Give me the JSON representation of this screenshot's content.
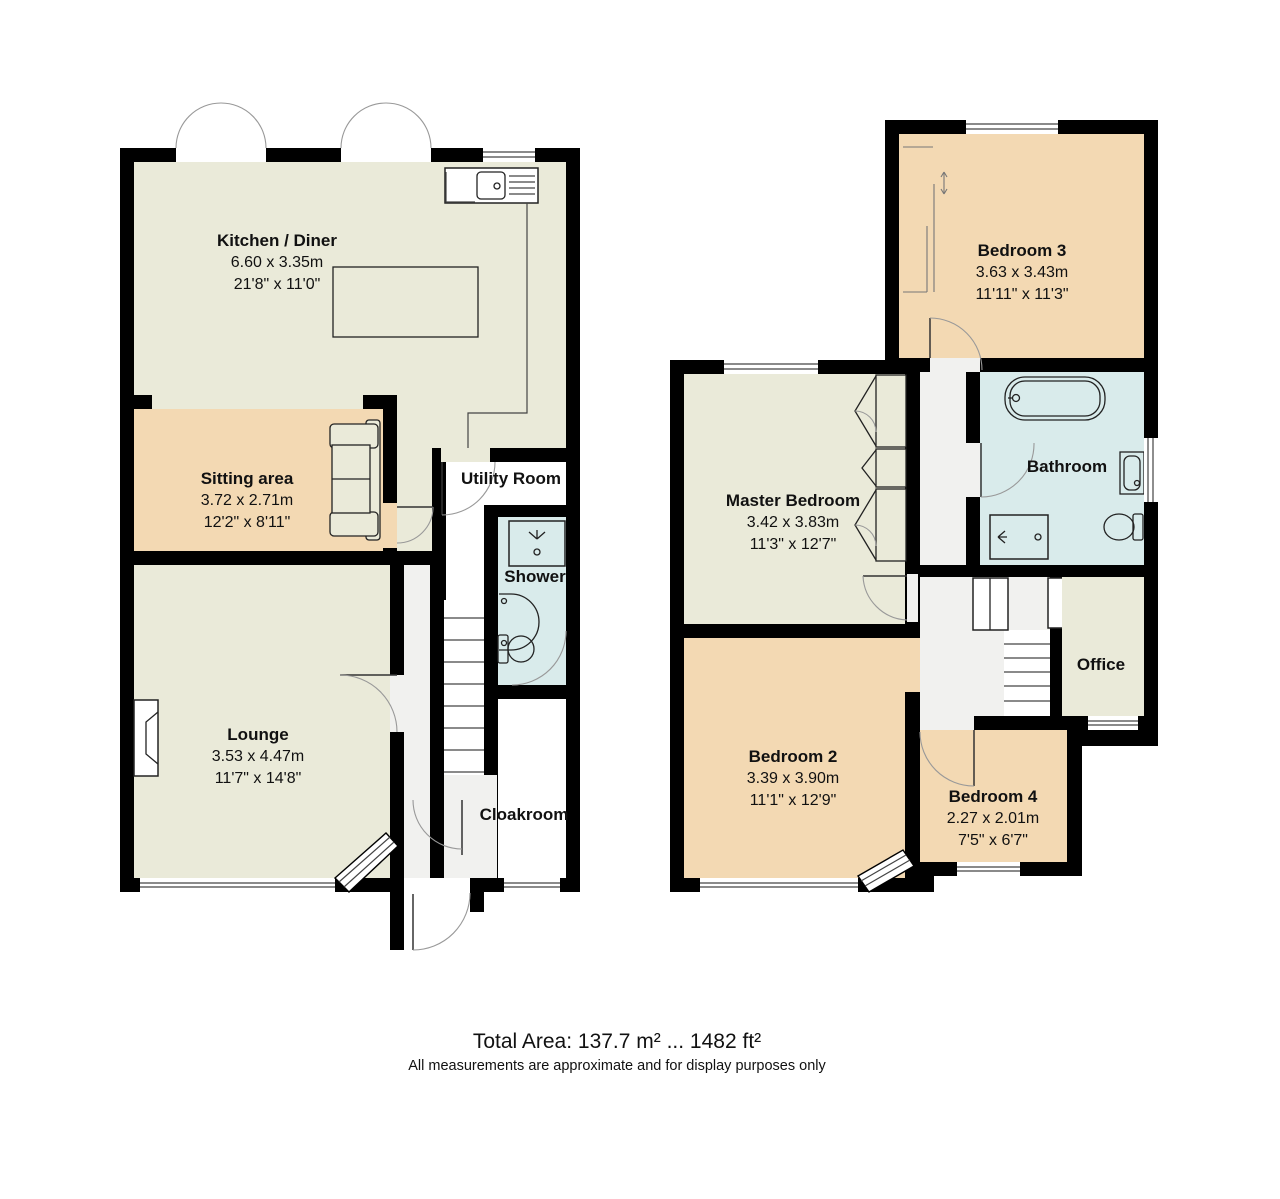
{
  "title": "Floor plan",
  "colors": {
    "wall": "#000000",
    "floor_main": "#eaead9",
    "floor_accent": "#f3d9b3",
    "floor_wet": "#d9ebeb",
    "floor_hall": "#f1f1ef"
  },
  "rooms": [
    {
      "name": "Kitchen / Diner",
      "size_m": "6.60 x 3.35m",
      "size_ft": "21'8\" x 11'0\""
    },
    {
      "name": "Sitting area",
      "size_m": "3.72 x 2.71m",
      "size_ft": "12'2\" x 8'11\""
    },
    {
      "name": "Lounge",
      "size_m": "3.53 x 4.47m",
      "size_ft": "11'7\" x 14'8\""
    },
    {
      "name": "Utility Room"
    },
    {
      "name": "Shower"
    },
    {
      "name": "Cloakroom"
    },
    {
      "name": "Master Bedroom",
      "size_m": "3.42 x 3.83m",
      "size_ft": "11'3\" x 12'7\""
    },
    {
      "name": "Bathroom"
    },
    {
      "name": "Bedroom 2",
      "size_m": "3.39 x 3.90m",
      "size_ft": "11'1\" x 12'9\""
    },
    {
      "name": "Bedroom 3",
      "size_m": "3.63 x 3.43m",
      "size_ft": "11'11\" x 11'3\""
    },
    {
      "name": "Bedroom 4",
      "size_m": "2.27 x 2.01m",
      "size_ft": "7'5\" x 6'7\""
    },
    {
      "name": "Office"
    }
  ],
  "icons": {
    "kitchen_sink": "sink-with-drainer",
    "island": "kitchen-island",
    "sofa": "sofa",
    "fireplace": "fireplace",
    "shower_cubicle": "shower",
    "wash_basin": "basin",
    "toilet": "toilet",
    "bath": "bathtub",
    "stairs": "stairs",
    "wardrobe": "fitted-wardrobes"
  },
  "footer": {
    "total_area": "Total Area: 137.7 m² ... 1482 ft²",
    "disclaimer": "All measurements are approximate and for display purposes only"
  }
}
